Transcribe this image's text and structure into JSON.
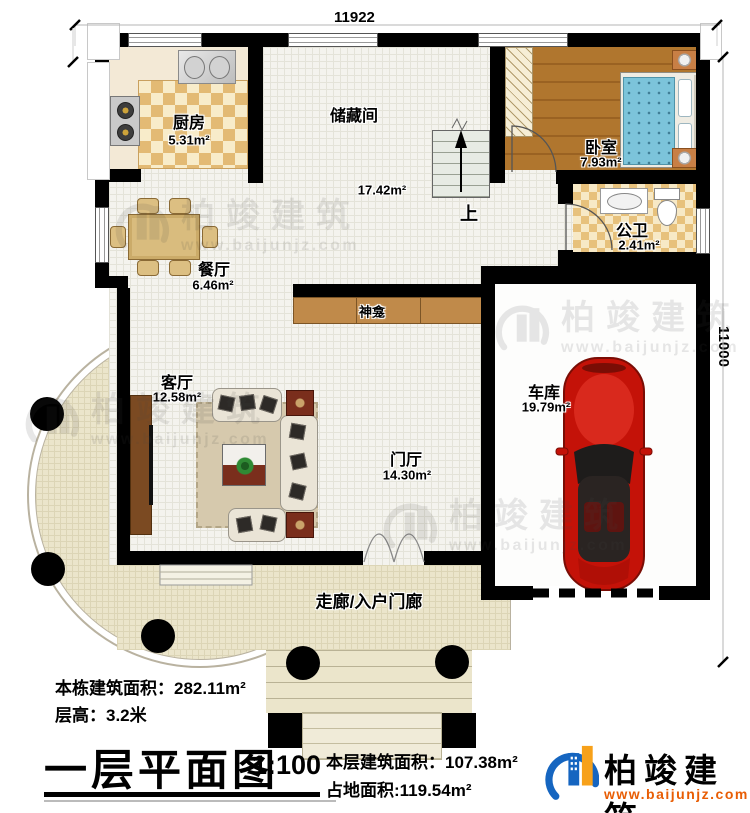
{
  "dimensions": {
    "top": "11922",
    "right": "11000"
  },
  "rooms": {
    "kitchen": {
      "name": "厨房",
      "area": "5.31m²"
    },
    "storage": {
      "name": "储藏间",
      "area": "17.42m²"
    },
    "bedroom": {
      "name": "卧室",
      "area": "7.93m²"
    },
    "bathroom": {
      "name": "公卫",
      "area": "2.41m²"
    },
    "dining": {
      "name": "餐厅",
      "area": "6.46m²"
    },
    "living": {
      "name": "客厅",
      "area": "12.58m²"
    },
    "foyer": {
      "name": "门厅",
      "area": "14.30m²"
    },
    "garage": {
      "name": "车库",
      "area": "19.79m²"
    },
    "shrine": {
      "name": "神龛"
    },
    "corridor": {
      "name": "走廊/入户门廊"
    },
    "stairs": {
      "up_label": "上"
    }
  },
  "title_block": {
    "building_total_area": "本栋建筑面积：282.11m²",
    "floor_height": "层高：3.2米",
    "plan_title": "一层平面图",
    "scale": "1:100",
    "floor_area": "本层建筑面积：107.38m²",
    "footprint_area": "占地面积:119.54m²"
  },
  "brand": {
    "name": "柏竣建筑",
    "website": "www.baijunjz.com"
  },
  "watermark": {
    "name": "柏竣建筑",
    "website": "www.baijunjz.com"
  },
  "colors": {
    "wall": "#000000",
    "logo_blue": "#1565c0",
    "logo_orange": "#f7a11a",
    "website_orange": "#e85d04",
    "porch_floor": "#ebe5cb",
    "bedroom_floor": "#b0762e",
    "car_red": "#c41208"
  }
}
